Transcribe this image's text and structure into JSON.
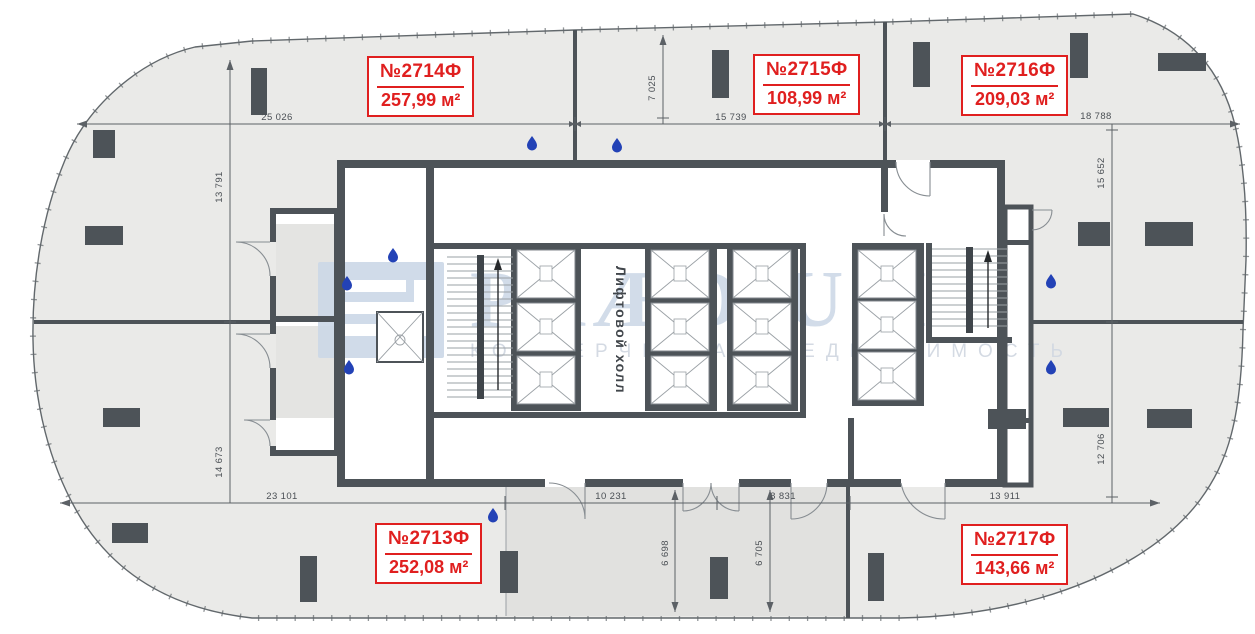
{
  "units": {
    "u2714": {
      "number": "№2714Ф",
      "area": "257,99 м²"
    },
    "u2715": {
      "number": "№2715Ф",
      "area": "108,99 м²"
    },
    "u2716": {
      "number": "№2716Ф",
      "area": "209,03 м²"
    },
    "u2713": {
      "number": "№2713Ф",
      "area": "252,08 м²"
    },
    "u2717": {
      "number": "№2717Ф",
      "area": "143,66 м²"
    }
  },
  "core": {
    "lift_hall": "Лифтовой холл"
  },
  "watermark": {
    "brand": "PRÆDIUM",
    "subtitle": "КОММЕРЧЕСКАЯ НЕДВИЖИМОСТЬ"
  },
  "dims": {
    "d25026": "25 026",
    "d15739": "15 739",
    "d18788": "18 788",
    "d13791": "13 791",
    "d14673": "14 673",
    "d7025": "7 025",
    "d15652": "15 652",
    "d12706": "12 706",
    "d23101": "23 101",
    "d10231": "10 231",
    "d8831": "8 831",
    "d13911": "13 911",
    "d6698": "6 698",
    "d6705": "6 705"
  },
  "icons": {
    "water_drop": "water-drop-icon"
  },
  "colors": {
    "unit_label_red": "#e01f1f",
    "wall": "#4d5358",
    "building_fill": "#eaeae8",
    "common_strip_fill": "#e1e1df",
    "water_drop_blue": "#2342b6",
    "watermark_blue": "#c7d4e4"
  }
}
